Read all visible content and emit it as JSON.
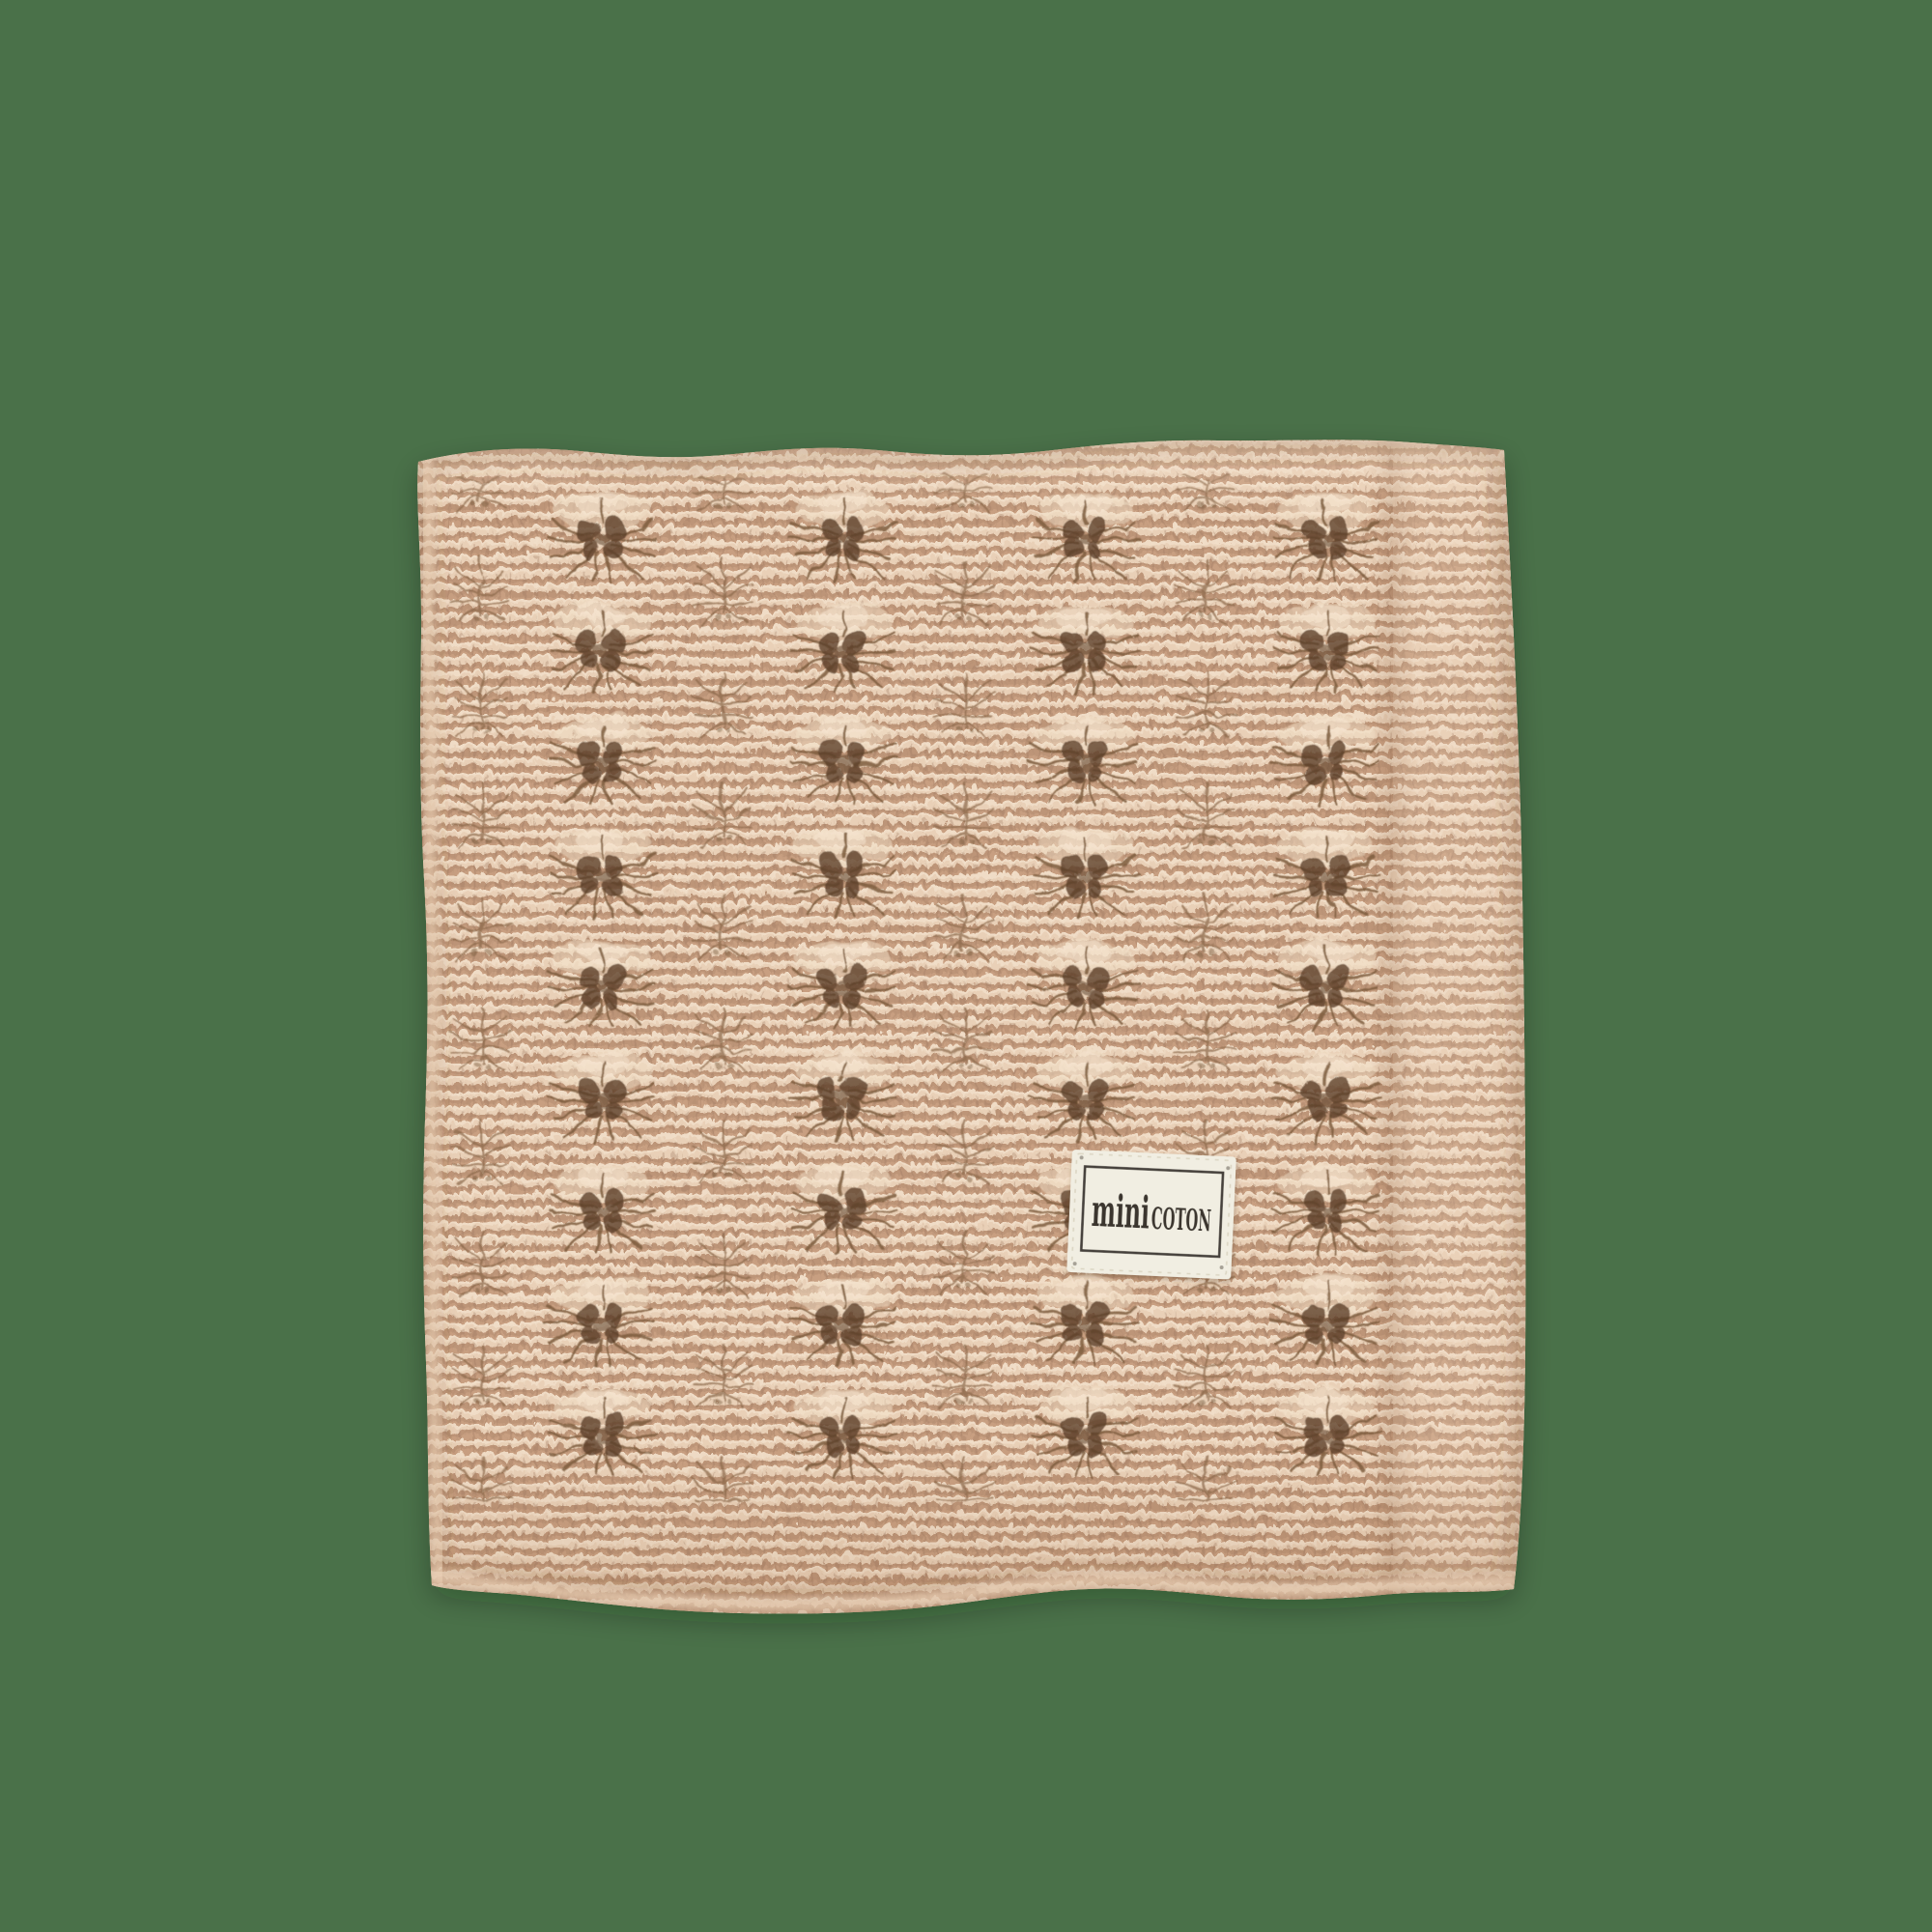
{
  "scene": {
    "description": "Folded beige openwork knitted baby blanket with a sewn-on fabric brand label, on a plain green background",
    "background_color": "#4a7149"
  },
  "blanket": {
    "base_color": "#d9b69a",
    "highlight_color": "#eed6be",
    "ridge_shadow_color": "#bd9678",
    "eyelet_color": "#593d27",
    "branch_color": "#826042",
    "pale_cap_color": "#f2dfc8",
    "pattern": "fan pointelle lace over garter stitch with plain garter fold band on the right and bottom"
  },
  "label": {
    "brand": "minicoton",
    "text_mini": "mini",
    "text_coton": "COTON",
    "fabric_color": "#f1eee2",
    "border_color": "#45403a",
    "text_color": "#3a362f"
  }
}
